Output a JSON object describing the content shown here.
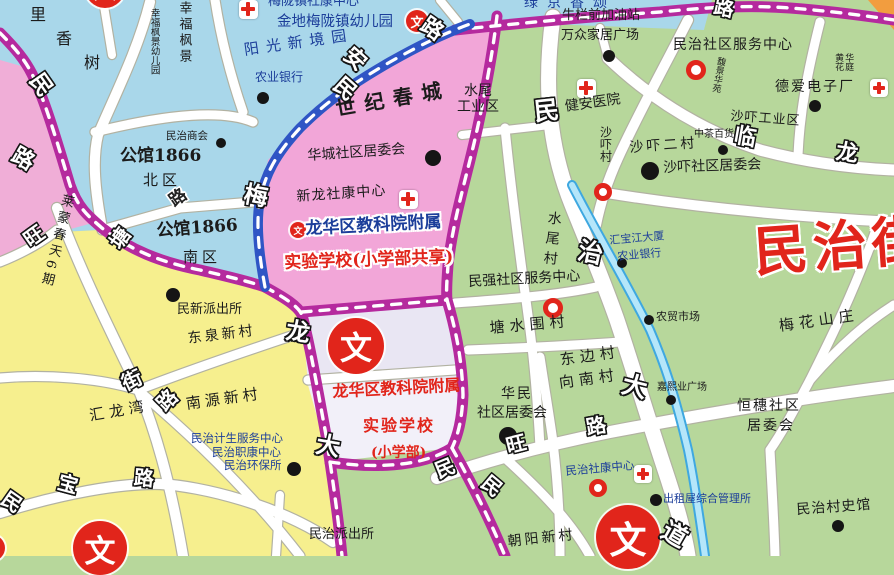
{
  "map": {
    "district_title": "民治街",
    "accent_colors": {
      "area_blue": "#a9d7ea",
      "area_pink": "#f2a6d8",
      "area_yellow": "#f6ef8e",
      "area_green": "#b7d79b",
      "school_block": "#e9e6f3",
      "road_purple": "#b52a9e",
      "road_blue": "#2f55c5",
      "river": "#3fa8e0",
      "poi_red": "#e1251b"
    },
    "icons": {
      "wen_glyph": "文"
    },
    "place_labels": [
      {
        "t": "里",
        "x": 30,
        "y": 6,
        "fs": 16
      },
      {
        "t": "香",
        "x": 56,
        "y": 30,
        "fs": 16
      },
      {
        "t": "树",
        "x": 84,
        "y": 54,
        "fs": 16
      },
      {
        "t": "幸福枫景",
        "x": 176,
        "y": 1,
        "fs": 13,
        "v": 1,
        "ls": 3
      },
      {
        "t": "幸福枫景幼儿园",
        "x": 148,
        "y": 8,
        "fs": 9.5,
        "v": 1
      },
      {
        "t": "梅陇镇社康中心",
        "x": 268,
        "y": -5,
        "fs": 13,
        "c": "blue"
      },
      {
        "t": "金地梅陇镇幼儿园",
        "x": 277,
        "y": 14,
        "fs": 14.5,
        "c": "blue"
      },
      {
        "t": "阳光新境园",
        "x": 243,
        "y": 42,
        "fs": 15,
        "c": "blue",
        "r": -8,
        "ls": 7
      },
      {
        "t": "绿京香颂",
        "x": 524,
        "y": -4,
        "fs": 14,
        "c": "blue",
        "ls": 9
      },
      {
        "t": "牛栏前加油站",
        "x": 562,
        "y": 9,
        "fs": 13
      },
      {
        "t": "万众家居广场",
        "x": 561,
        "y": 29,
        "fs": 13
      },
      {
        "t": "民治社区服务中心",
        "x": 673,
        "y": 38,
        "fs": 14,
        "ls": 1
      },
      {
        "t": "馥景华苑",
        "x": 716,
        "y": 56,
        "fs": 9,
        "v": 1,
        "r": 10
      },
      {
        "t": "德爱电子厂",
        "x": 775,
        "y": 80,
        "fs": 14,
        "ls": 2
      },
      {
        "t": "黄花\n华庭",
        "x": 833,
        "y": 53,
        "fs": 9,
        "v": 2
      },
      {
        "t": "健安医院",
        "x": 564,
        "y": 100,
        "fs": 14,
        "r": -8
      },
      {
        "t": "农业银行",
        "x": 255,
        "y": 71,
        "fs": 12,
        "c": "blue"
      },
      {
        "t": "沙吓村",
        "x": 598,
        "y": 126,
        "fs": 12,
        "v": 1
      },
      {
        "t": "沙吓工业区",
        "x": 731,
        "y": 110,
        "fs": 13,
        "r": 4,
        "ls": 1
      },
      {
        "t": "中茶百货",
        "x": 694,
        "y": 129,
        "fs": 10
      },
      {
        "t": "沙吓二村",
        "x": 629,
        "y": 141,
        "fs": 14,
        "r": -4,
        "ls": 3
      },
      {
        "t": "沙吓社区居委会",
        "x": 663,
        "y": 161,
        "fs": 14,
        "r": -2
      },
      {
        "t": "世纪春城",
        "x": 334,
        "y": 98,
        "fs": 20,
        "b": 1,
        "r": -10,
        "ls": 9
      },
      {
        "t": "华城社区居委会",
        "x": 307,
        "y": 149,
        "fs": 14,
        "r": -4
      },
      {
        "t": "水尾\n工业区",
        "x": 457,
        "y": 84,
        "fs": 14,
        "tc": 1
      },
      {
        "t": "新龙社康中心",
        "x": 296,
        "y": 190,
        "fs": 14,
        "r": -4,
        "ls": 1
      },
      {
        "t": "龙华区教科院附属",
        "x": 305,
        "y": 220,
        "fs": 17,
        "b": 1,
        "c": "blue",
        "h": 1,
        "r": -3
      },
      {
        "t": "实验学校(小学部共享)",
        "x": 284,
        "y": 254,
        "fs": 17,
        "b": 1,
        "c": "red",
        "h": 1,
        "r": -2
      },
      {
        "t": "民治商会",
        "x": 166,
        "y": 131,
        "fs": 10.5
      },
      {
        "t": "公馆1866",
        "x": 120,
        "y": 147,
        "fs": 17,
        "b": 1
      },
      {
        "t": "北区",
        "x": 143,
        "y": 172,
        "fs": 15,
        "ls": 4
      },
      {
        "t": "公馆1866",
        "x": 156,
        "y": 222,
        "fs": 17,
        "b": 1,
        "r": -4
      },
      {
        "t": "南区",
        "x": 183,
        "y": 249,
        "fs": 15,
        "ls": 4
      },
      {
        "t": "莱蒙春天6期",
        "x": 60,
        "y": 192,
        "fs": 13,
        "v": 1,
        "r": 14,
        "ls": 4
      },
      {
        "t": "民新派出所",
        "x": 177,
        "y": 303,
        "fs": 13
      },
      {
        "t": "东泉新村",
        "x": 187,
        "y": 332,
        "fs": 14,
        "r": -7,
        "ls": 3
      },
      {
        "t": "南源新村",
        "x": 185,
        "y": 396,
        "fs": 15,
        "r": -8,
        "ls": 4
      },
      {
        "t": "汇龙湾",
        "x": 88,
        "y": 408,
        "fs": 15,
        "r": -10,
        "ls": 5
      },
      {
        "t": "民治计生服务中心",
        "x": 191,
        "y": 432,
        "fs": 11.5,
        "c": "blue"
      },
      {
        "t": "民治职康中心",
        "x": 212,
        "y": 446,
        "fs": 11.5,
        "c": "blue"
      },
      {
        "t": "民治环保所",
        "x": 224,
        "y": 459,
        "fs": 11.5,
        "c": "blue"
      },
      {
        "t": "民治派出所",
        "x": 309,
        "y": 528,
        "fs": 13
      },
      {
        "t": "朝阳新村",
        "x": 507,
        "y": 535,
        "fs": 14,
        "r": -6,
        "ls": 3
      },
      {
        "t": "龙华区教科院附属",
        "x": 332,
        "y": 383,
        "fs": 16,
        "b": 1,
        "c": "red",
        "r": -3
      },
      {
        "t": "实验学校",
        "x": 363,
        "y": 417,
        "fs": 16,
        "b": 1,
        "c": "red",
        "ls": 2
      },
      {
        "t": "(小学部)",
        "x": 371,
        "y": 446,
        "fs": 14,
        "b": 1,
        "c": "red"
      },
      {
        "t": "民强社区服务中心",
        "x": 468,
        "y": 275,
        "fs": 14,
        "r": -3
      },
      {
        "t": "水尾村",
        "x": 546,
        "y": 210,
        "fs": 14,
        "v": 1,
        "r": 6,
        "ls": 6
      },
      {
        "t": "塘水围村",
        "x": 489,
        "y": 320,
        "fs": 15,
        "r": -5,
        "ls": 5
      },
      {
        "t": "东边村",
        "x": 559,
        "y": 352,
        "fs": 15,
        "r": -8,
        "ls": 5
      },
      {
        "t": "向南村",
        "x": 558,
        "y": 375,
        "fs": 15,
        "r": -8,
        "ls": 5
      },
      {
        "t": "华民",
        "x": 501,
        "y": 387,
        "fs": 14,
        "ls": 2
      },
      {
        "t": "社区居委会",
        "x": 477,
        "y": 406,
        "fs": 14
      },
      {
        "t": "汇宝江大厦",
        "x": 609,
        "y": 235,
        "fs": 11,
        "c": "blue",
        "r": -5
      },
      {
        "t": "农业银行",
        "x": 617,
        "y": 251,
        "fs": 11,
        "c": "blue",
        "r": -5
      },
      {
        "t": "农贸市场",
        "x": 656,
        "y": 311,
        "fs": 11
      },
      {
        "t": "梅花山庄",
        "x": 778,
        "y": 318,
        "fs": 15,
        "r": -8,
        "ls": 5
      },
      {
        "t": "恒穗社区",
        "x": 737,
        "y": 399,
        "fs": 14,
        "ls": 2
      },
      {
        "t": "居委会",
        "x": 747,
        "y": 419,
        "fs": 14,
        "ls": 2
      },
      {
        "t": "嘉熙业广场",
        "x": 657,
        "y": 382,
        "fs": 10
      },
      {
        "t": "出租屋综合管理所",
        "x": 663,
        "y": 493,
        "fs": 11,
        "c": "blue"
      },
      {
        "t": "民治社康中心",
        "x": 565,
        "y": 465,
        "fs": 11.5,
        "c": "blue",
        "r": -5
      },
      {
        "t": "民治村史馆",
        "x": 796,
        "y": 503,
        "fs": 14,
        "r": -4,
        "ls": 1
      },
      {
        "t": "民治街",
        "x": 752,
        "y": 222,
        "fs": 54,
        "b": 1,
        "c": "red",
        "h": 1,
        "r": -4,
        "ls": 5,
        "n": "district-title"
      }
    ],
    "road_labels": [
      {
        "t": "民",
        "x": 30,
        "y": 74,
        "fs": 22,
        "r": 55
      },
      {
        "t": "路",
        "x": 12,
        "y": 148,
        "fs": 22,
        "r": 30
      },
      {
        "t": "旺",
        "x": 24,
        "y": 226,
        "fs": 20,
        "r": -35
      },
      {
        "t": "塘",
        "x": 110,
        "y": 228,
        "fs": 20,
        "r": -55
      },
      {
        "t": "梅",
        "x": 244,
        "y": 184,
        "fs": 24,
        "r": 10
      },
      {
        "t": "龙",
        "x": 286,
        "y": 320,
        "fs": 24,
        "r": 8
      },
      {
        "t": "大",
        "x": 316,
        "y": 434,
        "fs": 24,
        "r": 10
      },
      {
        "t": "街",
        "x": 122,
        "y": 370,
        "fs": 20,
        "r": -25
      },
      {
        "t": "路",
        "x": 157,
        "y": 390,
        "fs": 20,
        "r": -45
      },
      {
        "t": "民",
        "x": 2,
        "y": 492,
        "fs": 20,
        "r": 35
      },
      {
        "t": "宝",
        "x": 58,
        "y": 474,
        "fs": 20,
        "r": 15
      },
      {
        "t": "路",
        "x": 134,
        "y": 468,
        "fs": 20,
        "r": 5
      },
      {
        "t": "民",
        "x": 334,
        "y": 78,
        "fs": 22,
        "r": 42
      },
      {
        "t": "安",
        "x": 344,
        "y": 48,
        "fs": 22,
        "r": 42
      },
      {
        "t": "路",
        "x": 421,
        "y": 18,
        "fs": 22,
        "r": 35
      },
      {
        "t": "路",
        "x": 714,
        "y": -2,
        "fs": 20,
        "r": 12
      },
      {
        "t": "民",
        "x": 534,
        "y": 98,
        "fs": 25,
        "r": -6
      },
      {
        "t": "治",
        "x": 578,
        "y": 240,
        "fs": 25,
        "r": 12
      },
      {
        "t": "大",
        "x": 622,
        "y": 374,
        "fs": 25,
        "r": 14
      },
      {
        "t": "道",
        "x": 662,
        "y": 522,
        "fs": 25,
        "r": 30
      },
      {
        "t": "民",
        "x": 435,
        "y": 458,
        "fs": 20,
        "r": -22
      },
      {
        "t": "旺",
        "x": 506,
        "y": 434,
        "fs": 20,
        "r": -14
      },
      {
        "t": "路",
        "x": 586,
        "y": 416,
        "fs": 20,
        "r": -10
      },
      {
        "t": "民",
        "x": 482,
        "y": 476,
        "fs": 20,
        "r": 40
      },
      {
        "t": "临",
        "x": 734,
        "y": 126,
        "fs": 22,
        "r": 10
      },
      {
        "t": "龙",
        "x": 836,
        "y": 142,
        "fs": 22,
        "r": 8
      },
      {
        "t": "路",
        "x": 170,
        "y": 190,
        "fs": 17,
        "r": -35,
        "dark": 1
      }
    ],
    "pois": {
      "dots": [
        {
          "x": 221,
          "y": 143,
          "r": 5
        },
        {
          "x": 263,
          "y": 98,
          "r": 6
        },
        {
          "x": 433,
          "y": 158,
          "r": 8
        },
        {
          "x": 609,
          "y": 56,
          "r": 6
        },
        {
          "x": 815,
          "y": 106,
          "r": 6
        },
        {
          "x": 723,
          "y": 150,
          "r": 5
        },
        {
          "x": 650,
          "y": 171,
          "r": 9
        },
        {
          "x": 173,
          "y": 295,
          "r": 7
        },
        {
          "x": 622,
          "y": 263,
          "r": 5
        },
        {
          "x": 649,
          "y": 320,
          "r": 5
        },
        {
          "x": 671,
          "y": 400,
          "r": 5
        },
        {
          "x": 508,
          "y": 436,
          "r": 9
        },
        {
          "x": 294,
          "y": 469,
          "r": 7
        },
        {
          "x": 656,
          "y": 500,
          "r": 6
        },
        {
          "x": 838,
          "y": 526,
          "r": 6
        }
      ],
      "red_rings": [
        {
          "x": 696,
          "y": 70,
          "r": 10
        },
        {
          "x": 553,
          "y": 308,
          "r": 10
        },
        {
          "x": 603,
          "y": 192,
          "r": 9
        },
        {
          "x": 598,
          "y": 488,
          "r": 9
        }
      ],
      "red_crosses": [
        {
          "x": 248,
          "y": 9,
          "s": 19
        },
        {
          "x": 408,
          "y": 199,
          "s": 19
        },
        {
          "x": 586,
          "y": 88,
          "s": 19
        },
        {
          "x": 879,
          "y": 88,
          "s": 18
        },
        {
          "x": 643,
          "y": 474,
          "s": 18
        }
      ],
      "wen_circles": [
        {
          "x": 356,
          "y": 346,
          "r": 28
        },
        {
          "x": 628,
          "y": 537,
          "r": 32
        },
        {
          "x": 100,
          "y": 548,
          "r": 27
        },
        {
          "x": 417,
          "y": 21,
          "r": 11
        },
        {
          "x": 105,
          "y": -12,
          "r": 20
        },
        {
          "x": 298,
          "y": 230,
          "r": 8
        },
        {
          "x": -8,
          "y": 548,
          "r": 13
        }
      ]
    }
  }
}
